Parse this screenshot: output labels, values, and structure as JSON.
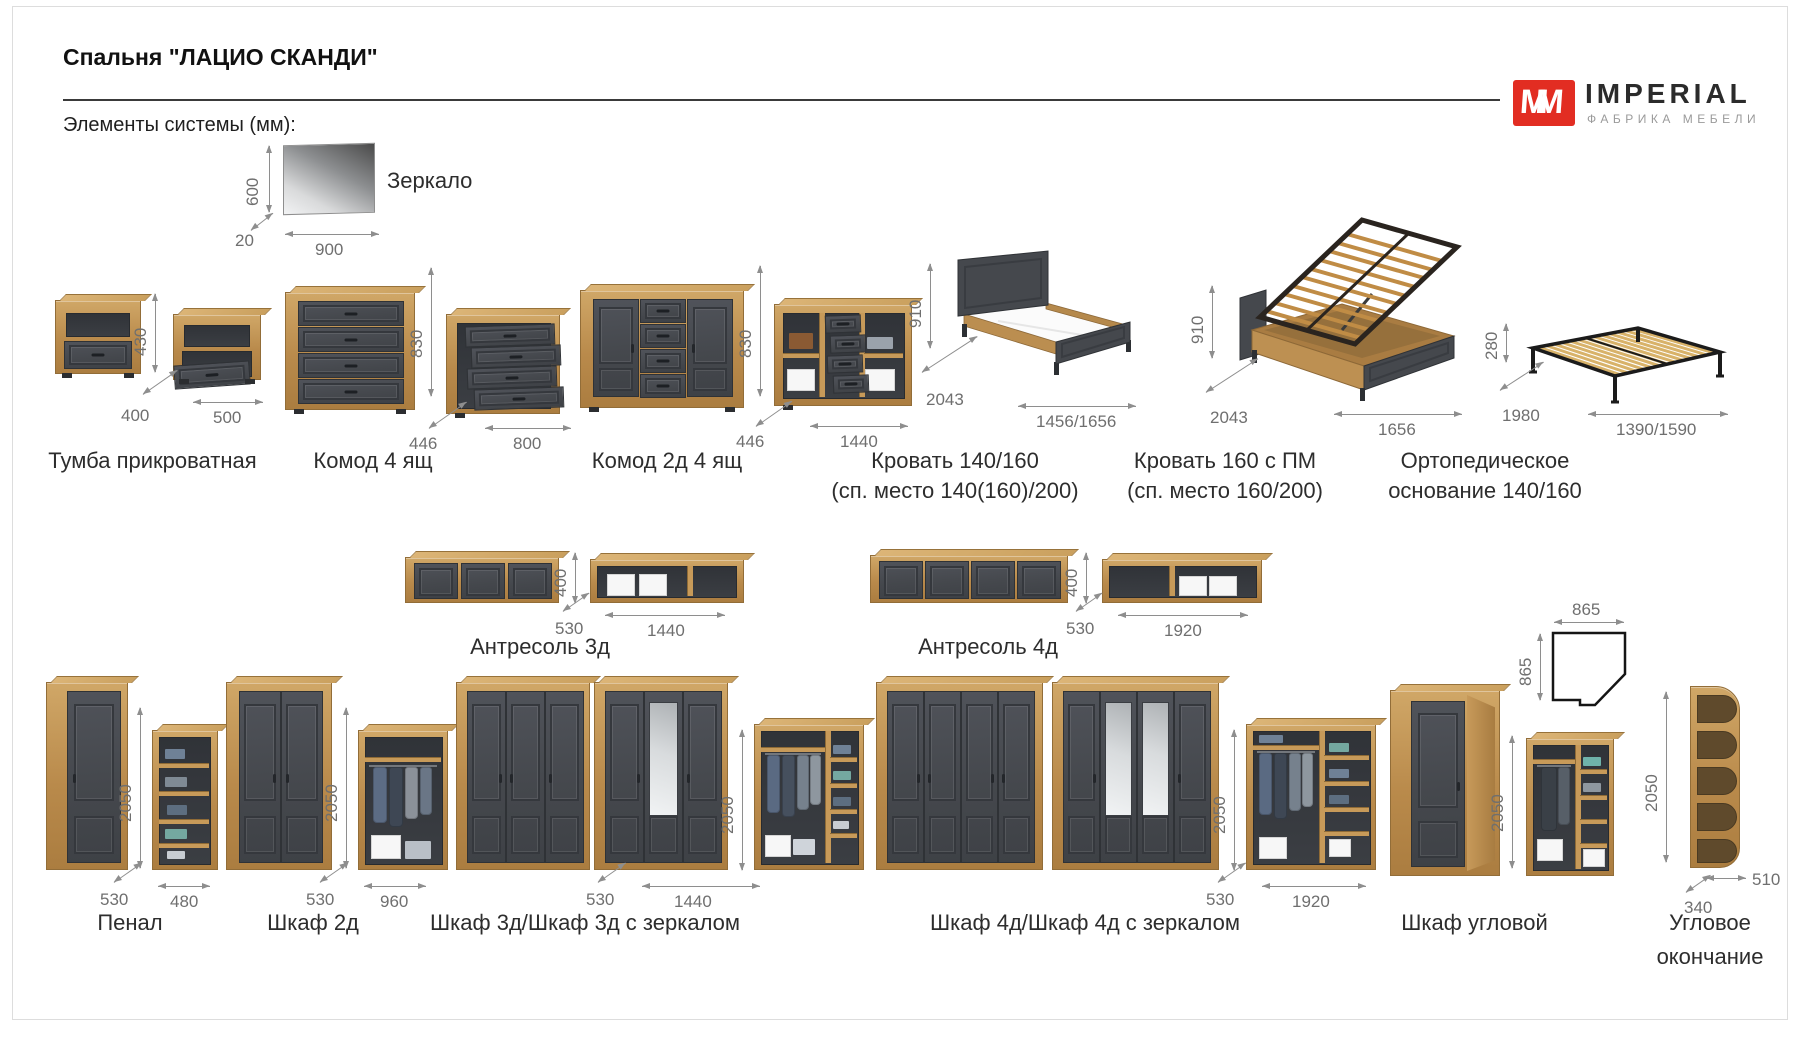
{
  "header": {
    "title": "Спальня \"ЛАЦИО СКАНДИ\"",
    "subtitle": "Элементы системы (мм):"
  },
  "logo": {
    "mark": "MM",
    "brand": "IMPERIAL",
    "tagline": "ФАБРИКА МЕБЕЛИ"
  },
  "items": {
    "mirror": {
      "label": "Зеркало",
      "h": "600",
      "d": "20",
      "w": "900"
    },
    "nightstand": {
      "label": "Тумба прикроватная",
      "h": "430",
      "d": "400",
      "w": "500"
    },
    "dresser4": {
      "label": "Комод 4 ящ",
      "h": "830",
      "d": "446",
      "w": "800"
    },
    "dresser2d4": {
      "label": "Комод 2д 4 ящ",
      "h": "830",
      "d": "446",
      "w": "1440"
    },
    "bed140": {
      "label": "Кровать 140/160",
      "sub": "(сп. место 140(160)/200)",
      "h": "910",
      "d": "2043",
      "w": "1456/1656"
    },
    "bed160pm": {
      "label": "Кровать 160 с ПМ",
      "sub": "(сп. место 160/200)",
      "h": "910",
      "d": "2043",
      "w": "1656"
    },
    "orthobase": {
      "line1": "Ортопедическое",
      "line2": "основание 140/160",
      "h": "280",
      "d": "1980",
      "w": "1390/1590"
    },
    "shelf3": {
      "label": "Антресоль 3д",
      "h": "400",
      "d": "530",
      "w": "1440"
    },
    "shelf4": {
      "label": "Антресоль 4д",
      "h": "400",
      "d": "530",
      "w": "1920"
    },
    "penal": {
      "label": "Пенал",
      "h": "2050",
      "d": "530",
      "w": "480"
    },
    "wardrobe2": {
      "label": "Шкаф 2д",
      "h": "2050",
      "d": "530",
      "w": "960"
    },
    "wardrobe3": {
      "label": "Шкаф 3д/Шкаф 3д с зеркалом",
      "h": "2050",
      "d": "530",
      "w": "1440"
    },
    "wardrobe4": {
      "label": "Шкаф 4д/Шкаф 4д с зеркалом",
      "h": "2050",
      "d": "530",
      "w": "1920"
    },
    "corner": {
      "label": "Шкаф угловой",
      "h": "2050",
      "plan_w": "865",
      "plan_d": "865"
    },
    "cornerend": {
      "line1": "Угловое",
      "line2": "окончание",
      "h": "2050",
      "d": "340",
      "w": "510"
    }
  }
}
